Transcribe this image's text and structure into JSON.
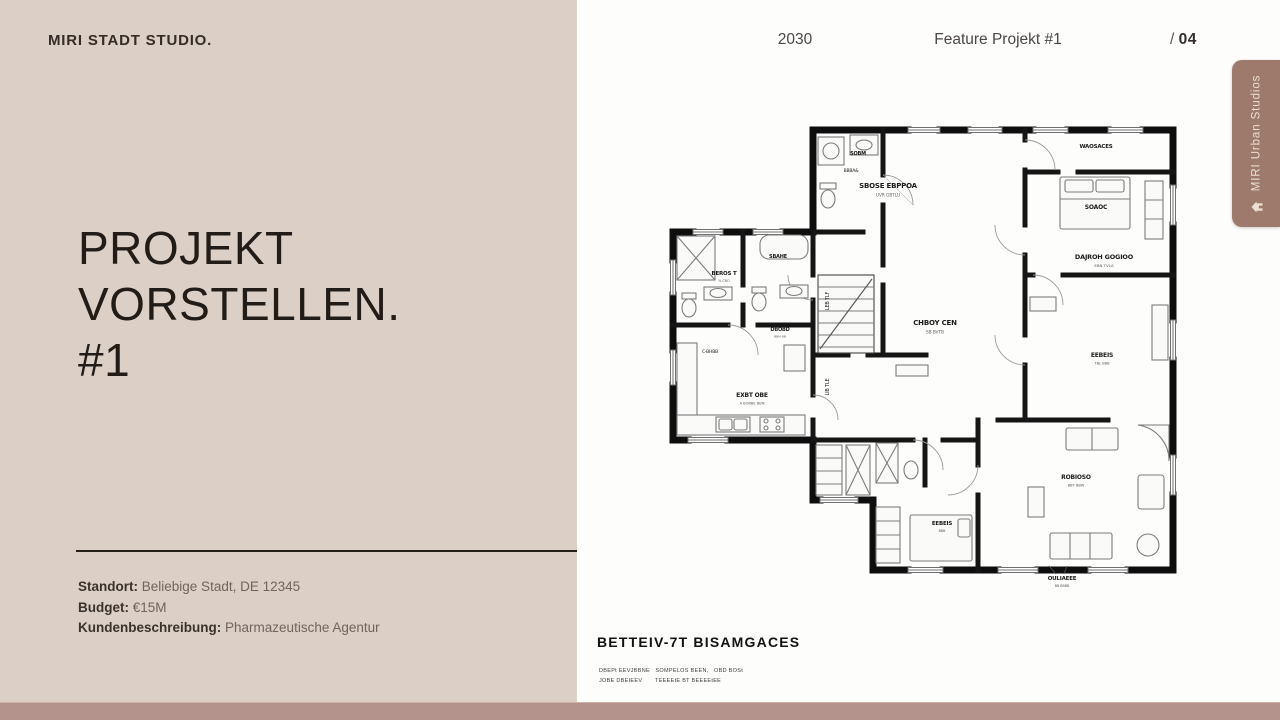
{
  "left_panel": {
    "logo": "MIRI STADT STUDIO.",
    "title_line1": "PROJEKT VORSTELLEN.",
    "title_line2": "#1",
    "details": [
      {
        "label": "Standort:",
        "value": "Beliebige Stadt, DE 12345"
      },
      {
        "label": "Budget:",
        "value": "€15M"
      },
      {
        "label": "Kundenbeschreibung:",
        "value": "Pharmazeutische Agentur"
      }
    ]
  },
  "header": {
    "year": "2030",
    "feature": "Feature Projekt #1",
    "page_prefix": "/ ",
    "page_number": "04"
  },
  "side_tab": {
    "label": "MIRI Urban Studios",
    "icon": "home-icon"
  },
  "floorplan": {
    "caption": "BETTEIV-7T BISAMGACES",
    "caption_sub1": "DBEPt EEVJBBNE   SOMPELOS BEEN,   OBD BOSt",
    "caption_sub2": "JOBE DBEIEEV       TEEEEtE BT BEEEEtEE",
    "labels": [
      {
        "t": "SBOSE EBPPOA",
        "x": 220,
        "y": 63,
        "s": 7,
        "b": true,
        "sub": "UVR GBTLU"
      },
      {
        "t": "SOBM",
        "x": 190,
        "y": 30,
        "s": 5,
        "b": true
      },
      {
        "t": "BBBA&",
        "x": 183,
        "y": 47,
        "s": 4.5
      },
      {
        "t": "WAOSACES",
        "x": 428,
        "y": 23,
        "s": 5.5,
        "b": true
      },
      {
        "t": "SOAOC",
        "x": 428,
        "y": 84,
        "s": 6,
        "b": true
      },
      {
        "t": "DAJROH GOGIOO",
        "x": 436,
        "y": 134,
        "s": 6.5,
        "b": true,
        "sub": "EBN TVLA"
      },
      {
        "t": "EEBEIS",
        "x": 434,
        "y": 232,
        "s": 6,
        "b": true,
        "sub": "TBL BBB"
      },
      {
        "t": "ROBIOSO",
        "x": 408,
        "y": 354,
        "s": 6,
        "b": true,
        "sub": "BBT BBW"
      },
      {
        "t": "CHBOY CEN",
        "x": 267,
        "y": 200,
        "s": 7,
        "b": true,
        "sub": "SB BVTB"
      },
      {
        "t": "BEROS T",
        "x": 56,
        "y": 150,
        "s": 5.5,
        "b": true,
        "sub": "% CRO"
      },
      {
        "t": "SBAHE",
        "x": 110,
        "y": 133,
        "s": 5,
        "b": true
      },
      {
        "t": "DBOBD",
        "x": 112,
        "y": 206,
        "s": 5,
        "b": true,
        "sub": "BBM BB"
      },
      {
        "t": "C-BHBB",
        "x": 42,
        "y": 228,
        "s": 4.5
      },
      {
        "t": "EXBT OBE",
        "x": 84,
        "y": 272,
        "s": 6,
        "b": true,
        "sub": "A BORBE BBN"
      },
      {
        "t": "EEBEIS",
        "x": 274,
        "y": 400,
        "s": 5.5,
        "b": true,
        "sub": "BBB"
      },
      {
        "t": "LEB TLF",
        "x": 161,
        "y": 176,
        "s": 5,
        "r": -90
      },
      {
        "t": "LIB TLE",
        "x": 161,
        "y": 262,
        "s": 5,
        "r": -90
      },
      {
        "t": "OULIAEEE",
        "x": 394,
        "y": 455,
        "s": 5.5,
        "b": true,
        "sub": "BB BBBB"
      }
    ]
  },
  "colors": {
    "left_bg": "#dccfc6",
    "right_bg": "#fdfdfb",
    "accent_tab": "#9d7a6b",
    "bottom_strip": "#b4938c",
    "title_text": "#221c18",
    "body_text": "#6f655d",
    "header_text": "#4b4744"
  }
}
